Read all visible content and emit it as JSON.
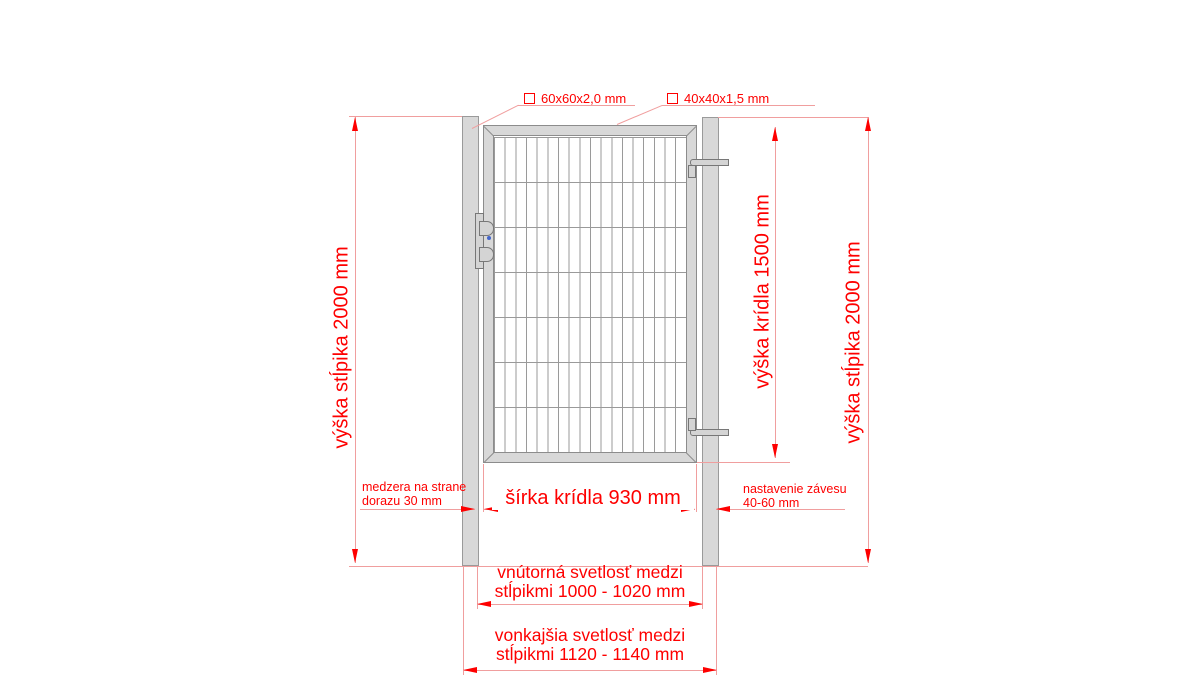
{
  "drawing": {
    "profile_labels": {
      "post": "60x60x2,0 mm",
      "frame": "40x40x1,5 mm"
    },
    "dims": {
      "post_height": "výška stĺpika 2000 mm",
      "leaf_height": "výška krídla 1500 mm",
      "leaf_width": "šírka krídla 930 mm",
      "latch_gap": [
        "medzera na strane",
        "dorazu 30 mm"
      ],
      "hinge_adjust": [
        "nastavenie závesu",
        "40-60 mm"
      ],
      "inner_clearance": [
        "vnútorná svetlosť medzi",
        "stĺpikmi 1000 - 1020 mm"
      ],
      "outer_clearance": [
        "vonkajšia svetlosť medzi",
        "stĺpikmi 1120 - 1140 mm"
      ]
    },
    "colors": {
      "dimension_red": "#fe0000",
      "dimension_line_pink": "#f09e9e",
      "metal_fill": "#d8d8d8",
      "metal_outline": "#8f8f8f",
      "mesh_line": "#9a9a9a"
    }
  }
}
